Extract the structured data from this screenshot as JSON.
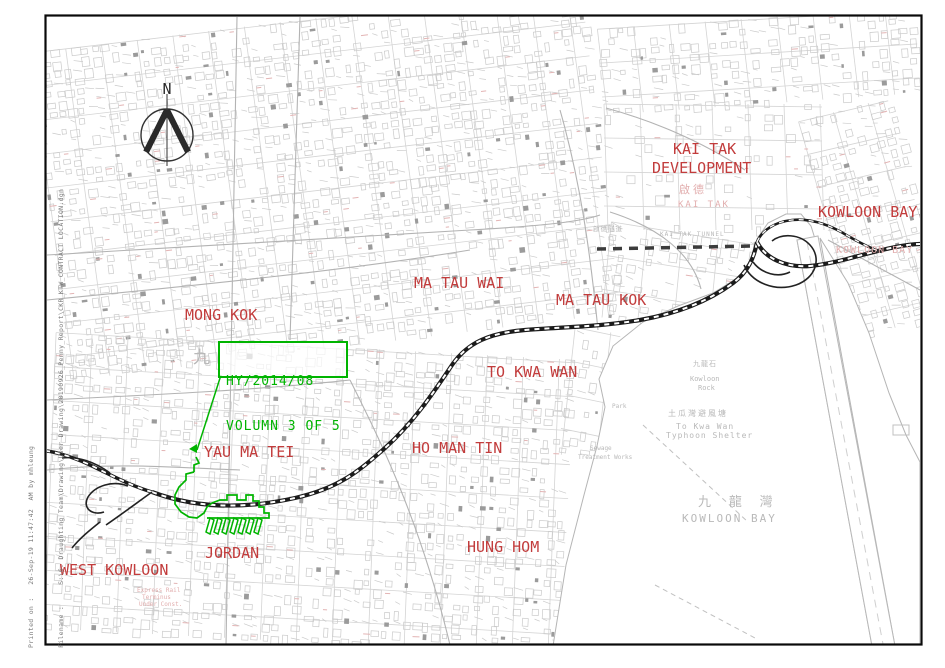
{
  "drawing": {
    "title_box": {
      "line1": "HY/2014/08",
      "line2": "VOLUMN 3 OF 5"
    },
    "north_label": "N",
    "plot_info": {
      "printed_on": "Printed on :   26-Sep-19 11:47:42  AM by mhleung",
      "filename": "Filename :     S:\\6. Draughting Team\\Drawing\\User Drawing\\20190926_Penny_Report\\CKR_KTW_CONTRACT LOCATION.dgn"
    },
    "colors": {
      "district_red": "#c23c3c",
      "faint_red": "#e2aeae",
      "water_gray": "#b9b9b9",
      "boundary_green": "#00b400",
      "alignment_dark": "#1b1b1b",
      "map_line_gray": "#cacaca"
    },
    "labels": [
      {
        "id": "mong-kok",
        "text": "MONG KOK",
        "x": 185,
        "y": 308,
        "fs": 15,
        "cls": "district"
      },
      {
        "id": "ma-tau-wai",
        "text": "MA TAU WAI",
        "x": 414,
        "y": 276,
        "fs": 15,
        "cls": "district"
      },
      {
        "id": "ma-tau-kok",
        "text": "MA TAU KOK",
        "x": 556,
        "y": 293,
        "fs": 15,
        "cls": "district"
      },
      {
        "id": "kai-tak-dev-1",
        "text": "KAI TAK",
        "x": 673,
        "y": 142,
        "fs": 15,
        "cls": "district"
      },
      {
        "id": "kai-tak-dev-2",
        "text": "DEVELOPMENT",
        "x": 652,
        "y": 161,
        "fs": 15,
        "cls": "district"
      },
      {
        "id": "kowloon-bay",
        "text": "KOWLOON BAY",
        "x": 818,
        "y": 205,
        "fs": 15,
        "cls": "district"
      },
      {
        "id": "to-kwa-wan",
        "text": "TO KWA WAN",
        "x": 487,
        "y": 365,
        "fs": 15,
        "cls": "district"
      },
      {
        "id": "ho-man-tin",
        "text": "HO MAN TIN",
        "x": 412,
        "y": 441,
        "fs": 15,
        "cls": "district"
      },
      {
        "id": "yau-ma-tei",
        "text": "YAU MA TEI",
        "x": 204,
        "y": 445,
        "fs": 15,
        "cls": "district"
      },
      {
        "id": "jordan",
        "text": "JORDAN",
        "x": 205,
        "y": 546,
        "fs": 15,
        "cls": "district"
      },
      {
        "id": "hung-hom",
        "text": "HUNG HOM",
        "x": 467,
        "y": 540,
        "fs": 15,
        "cls": "district"
      },
      {
        "id": "west-kowloon",
        "text": "WEST KOWLOON",
        "x": 60,
        "y": 563,
        "fs": 15,
        "cls": "district"
      },
      {
        "id": "kai-tak-cjk",
        "text": "啟德",
        "x": 679,
        "y": 184,
        "fs": 11,
        "cls": "faint",
        "ls": 3
      },
      {
        "id": "kai-tak-sub",
        "text": "KAI TAK",
        "x": 678,
        "y": 201,
        "fs": 9,
        "cls": "faint",
        "ls": 2
      },
      {
        "id": "kowloon-bay-sub",
        "text": "KOWLOON BAY",
        "x": 836,
        "y": 246,
        "fs": 10,
        "cls": "faint",
        "ls": 1
      },
      {
        "id": "kowloon-bay-cjk",
        "text": "九 龍 灣",
        "x": 698,
        "y": 496,
        "fs": 13,
        "cls": "water",
        "ls": 5
      },
      {
        "id": "kowloon-bay-water",
        "text": "KOWLOON BAY",
        "x": 682,
        "y": 513,
        "fs": 11,
        "cls": "water",
        "ls": 2
      },
      {
        "id": "typhoon-cjk",
        "text": "土瓜灣避風塘",
        "x": 668,
        "y": 410,
        "fs": 8,
        "cls": "water",
        "ls": 2
      },
      {
        "id": "typhoon-1",
        "text": "To Kwa Wan",
        "x": 676,
        "y": 423,
        "fs": 8,
        "cls": "water",
        "ls": 1
      },
      {
        "id": "typhoon-2",
        "text": "Typhoon Shelter",
        "x": 666,
        "y": 432,
        "fs": 8,
        "cls": "water",
        "ls": 1
      },
      {
        "id": "kowloon-rock-cjk",
        "text": "九龍石",
        "x": 693,
        "y": 361,
        "fs": 7,
        "cls": "water",
        "ls": 1
      },
      {
        "id": "kowloon-rock-1",
        "text": "Kowloon",
        "x": 690,
        "y": 376,
        "fs": 7,
        "cls": "water"
      },
      {
        "id": "kowloon-rock-2",
        "text": "Rock",
        "x": 698,
        "y": 385,
        "fs": 7,
        "cls": "water"
      },
      {
        "id": "tunnel-cjk",
        "text": "啟德隧道",
        "x": 593,
        "y": 226,
        "fs": 6.5,
        "cls": "water",
        "ls": 1
      },
      {
        "id": "tunnel-en",
        "text": "KAI TAK TUNNEL",
        "x": 660,
        "y": 232,
        "fs": 6,
        "cls": "water",
        "ls": 1
      },
      {
        "id": "nine-cjk",
        "text": "九",
        "x": 193,
        "y": 350,
        "fs": 17,
        "cls": "water"
      },
      {
        "id": "park",
        "text": "Park",
        "x": 612,
        "y": 404,
        "fs": 6,
        "cls": "water"
      },
      {
        "id": "sewage-1",
        "text": "Sewage",
        "x": 590,
        "y": 446,
        "fs": 6,
        "cls": "water"
      },
      {
        "id": "sewage-2",
        "text": "Treatment Works",
        "x": 578,
        "y": 455,
        "fs": 6,
        "cls": "water"
      },
      {
        "id": "erl-1",
        "text": "Express Rail",
        "x": 137,
        "y": 588,
        "fs": 6,
        "cls": "faint"
      },
      {
        "id": "erl-2",
        "text": "Terminus",
        "x": 142,
        "y": 595,
        "fs": 6,
        "cls": "faint"
      },
      {
        "id": "erl-3",
        "text": "Under Const.",
        "x": 139,
        "y": 602,
        "fs": 6,
        "cls": "faint"
      }
    ]
  }
}
